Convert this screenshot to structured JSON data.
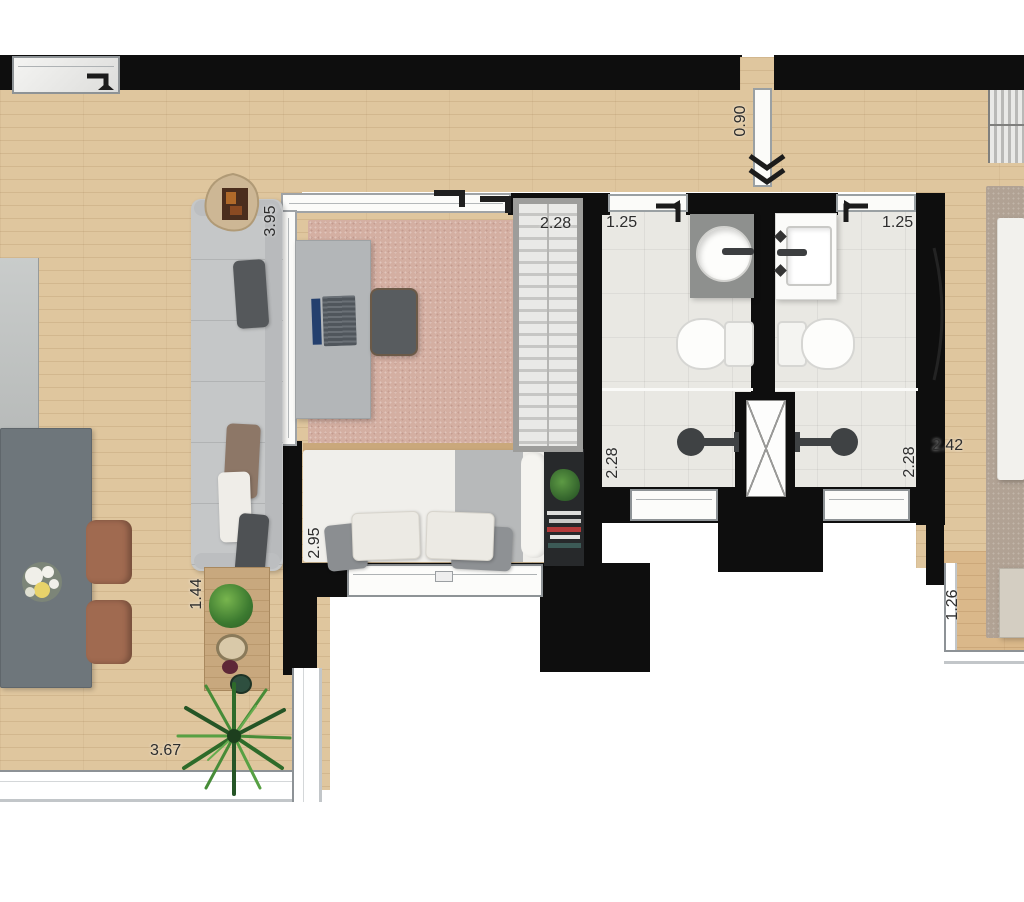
{
  "labels": {
    "d_sofa": "3.95",
    "d_closet": "2.28",
    "d_bath1w": "1.25",
    "d_bath2w": "1.25",
    "d_entry": "0.90",
    "d_bath1d": "2.28",
    "d_bath2d": "2.28",
    "d_master": "2.42",
    "d_bed1": "2.95",
    "d_balcony1": "1.44",
    "d_balcony2": "1.26",
    "d_balcony1w": "3.67"
  },
  "palette": {
    "wall": "#0e0e0e",
    "wood_floor": "#dfc69e",
    "balcony_wood": "#dab88a",
    "bath_tile": "#e9e8e3",
    "sofa_gray": "#c5c7c8",
    "table_gray": "#6e767b",
    "chair_brown": "#a06a50",
    "rug_pink": "#d4afa2",
    "rug_master": "#b1a294"
  },
  "icons": {
    "entry_direction": "double-chevron-down",
    "door_swing": "hook-arrow",
    "window_slide": "hook-arrow",
    "shaft": "x-cross"
  }
}
